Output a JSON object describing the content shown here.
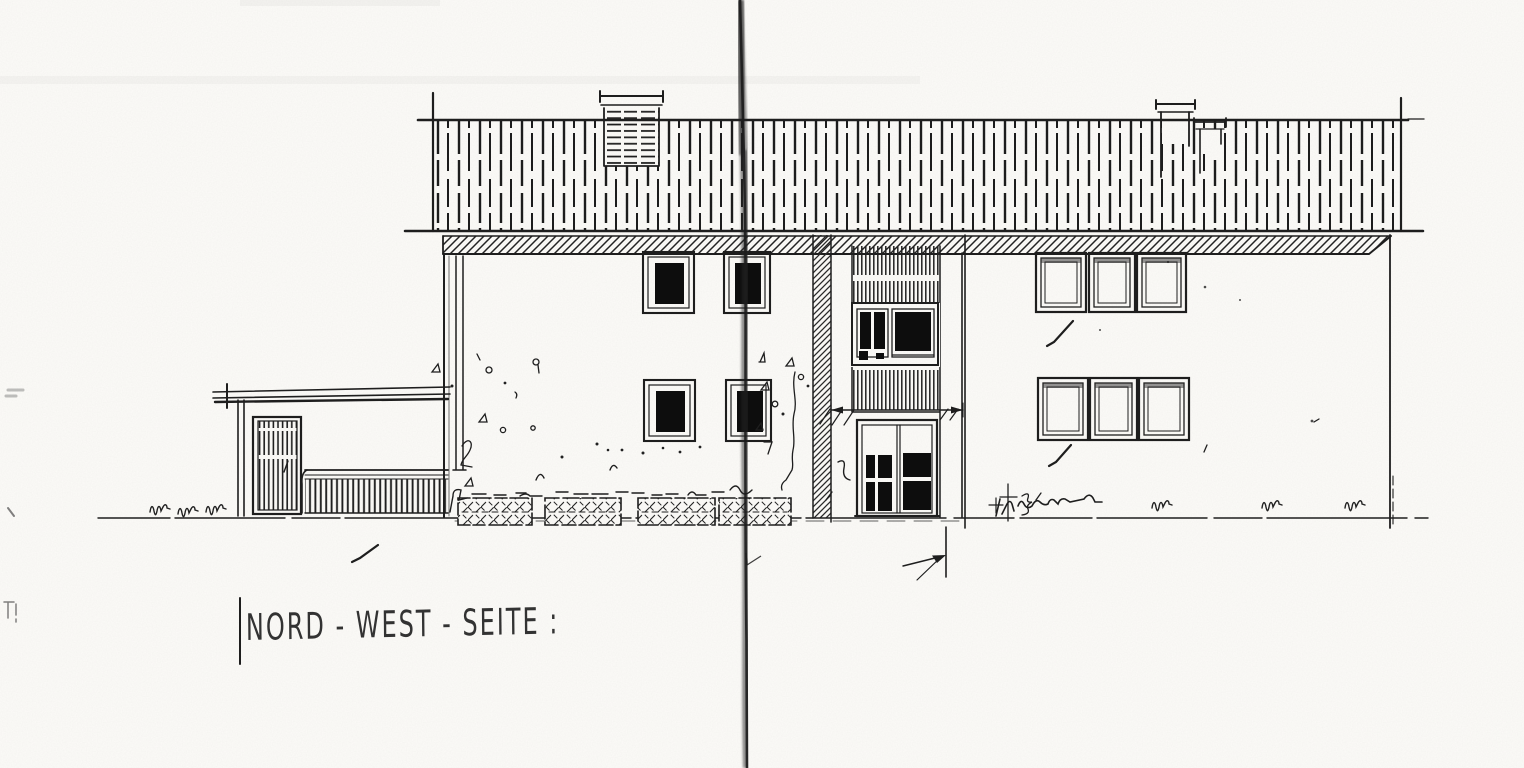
{
  "drawing": {
    "title": "NORD - WEST - SEITE :",
    "view": "north-west elevation",
    "colors": {
      "paper": "#fcfbf8",
      "ink": "#1f1f1f",
      "window_glass": "#0e0e0e",
      "fold_line": "#262626"
    }
  }
}
